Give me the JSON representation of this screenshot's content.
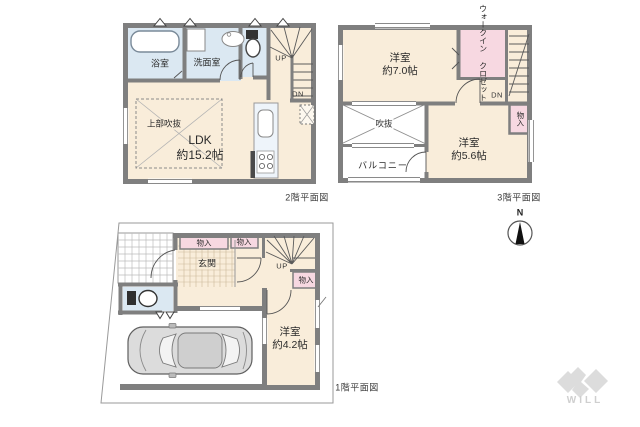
{
  "colors": {
    "room_cream": "#f9edda",
    "wet_blue": "#dbe8f2",
    "closet_pink": "#f7d8e1",
    "wall_gray": "#7f7f7f",
    "thin_line": "#555555",
    "lot_line": "#999999",
    "logo_gray": "#dcdcdc"
  },
  "floor2": {
    "caption": "2階平面図",
    "bathroom": "浴室",
    "washroom": "洗面室",
    "ldk_line1": "LDK",
    "ldk_line2": "約15.2帖",
    "void_above": "上部吹抜",
    "up": "UP",
    "dn": "DN"
  },
  "floor3": {
    "caption": "3階平面図",
    "bedroom1_line1": "洋室",
    "bedroom1_line2": "約7.0帖",
    "wic_line1": "ウォークイン",
    "wic_line2": "クロゼット",
    "bedroom2_line1": "洋室",
    "bedroom2_line2": "約5.6帖",
    "void": "吹抜",
    "balcony": "バルコニー",
    "storage": "物入",
    "dn": "DN"
  },
  "floor1": {
    "caption": "1階平面図",
    "entrance": "玄関",
    "storage1": "物入",
    "storage2": "物入",
    "storage3": "物入",
    "bedroom_line1": "洋室",
    "bedroom_line2": "約4.2帖",
    "up": "UP"
  },
  "compass": {
    "north": "N"
  },
  "logo": {
    "text": "WILL"
  }
}
